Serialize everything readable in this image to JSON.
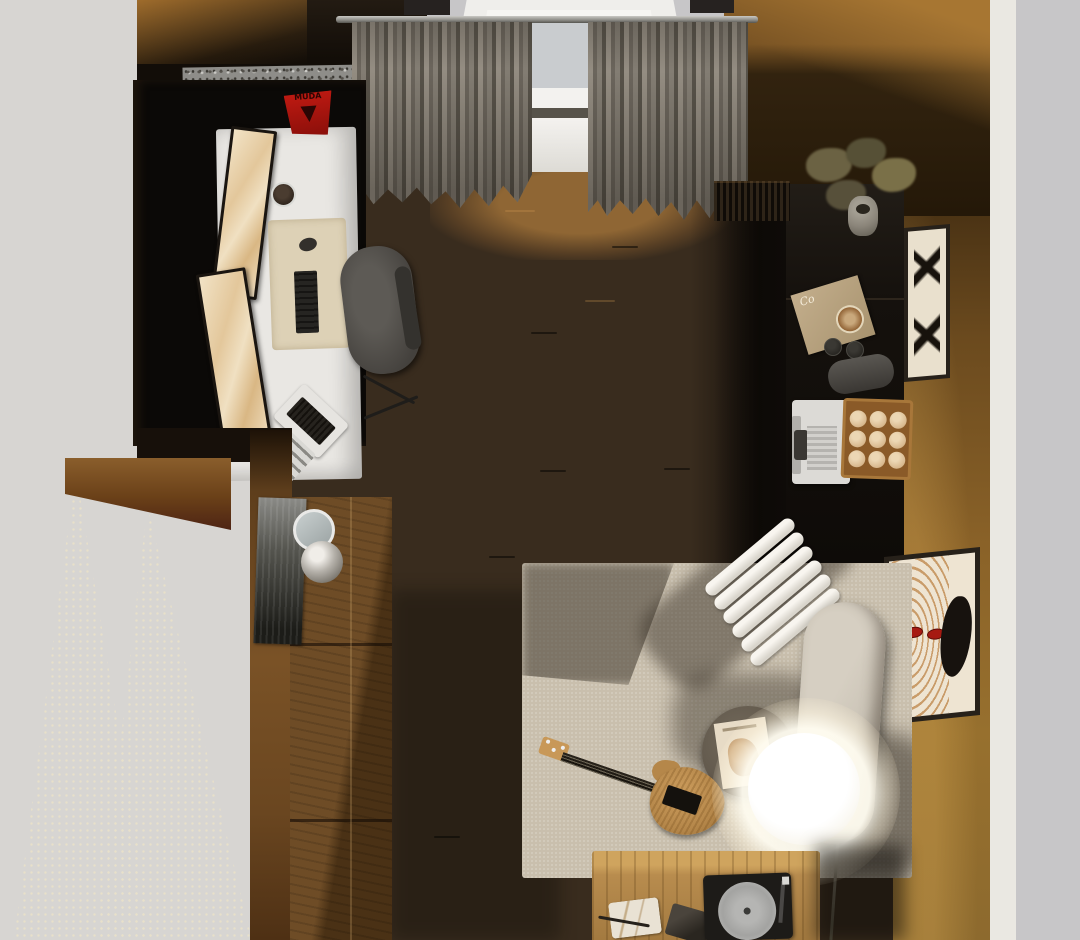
{
  "scene": {
    "type": "3d-room-render",
    "view": "top-down",
    "description": "Top-down render of a cozy home studio: white desk with dual monitors, window with gray curtains, walnut wardrobe, black coffee sideboard with espresso machine and cup tray, beige rug with electric guitar, white ribbed lounge chair, round side table, beige armchair, glowing globe floor lamp and oak media table with turntable"
  },
  "texts": {
    "desk_sign": "MUDA",
    "magazine_initial": "Co"
  },
  "counts": {
    "espresso_cups": 9,
    "lounge_chair_ribs": 6,
    "curtain_panels": 2,
    "monitors": 2,
    "wall_frames": 2
  },
  "palette": {
    "ext-gray": "#c7c6c8",
    "ext-gray-left": "#d7d5d2",
    "ext-dots": "#e8e0ca",
    "wall-white": "#eae8e2",
    "wall-amber": "#8a6228",
    "wall-amber-dark": "#3a270f",
    "wall-left": "#7a5226",
    "floor": "#392c1e",
    "floor-light": "#8a5e2c",
    "curtain": "#8a847a",
    "curtain-dark": "#5c574f",
    "rod": "#a8a7a3",
    "glass": "#c9cccf",
    "sill": "#f3f2ef",
    "desk": "#e9e7e3",
    "desk-mat": "#ddd1b6",
    "monitor-screen": "#ecdabb",
    "black-rug": "#0b0907",
    "chair": "#514e4a",
    "terrazzo": "#8e8d89",
    "sign-red": "#b01810",
    "cabinet-wood": "#5e3f1e",
    "sideboard-black": "#17130f",
    "rug": "#c9bfad",
    "rug-shadow": "rgba(62,54,44,0.55)",
    "tube-white": "#f3f0e9",
    "side-table": "#5f564a",
    "armchair": "#ccc5b8",
    "lamp-core": "#fffef6",
    "table-oak": "#b88c4e",
    "guitar-body": "#b5874a",
    "guitar-neck": "#211c15",
    "cup": "#d8b88e",
    "tray-wood": "#8a5a28",
    "machine-white": "#dcdad6",
    "frame-dark": "#27211a",
    "frame-mat": "#e9e0cd",
    "art-orange": "#c08a50",
    "art-red": "#a61a12",
    "poster-gray": "#66665f",
    "plant-olive": "#6b6243",
    "vase-gray": "#8b857a",
    "mirror-rim": "#e9e9e7",
    "sphere-silver": "#b5b1aa",
    "turntable": "#1d1b18",
    "platter": "#a3a3a1",
    "magazine-cover": "#b9a583",
    "laptop-white": "#e6e4e0"
  },
  "objects": {
    "window": "daylit window",
    "curtains": "gray curtain panels",
    "curtain_rod": "metal curtain rod",
    "terrazzo_ledge": "terrazzo ledge",
    "desk": "white desk",
    "monitors": "dual monitors with marble wallpaper",
    "keyboard": "black keyboard",
    "mouse": "mouse",
    "laptop": "open laptop",
    "desk_mat": "beige desk mat",
    "red_sign": "red desk sign",
    "office_chair": "dark office chair",
    "black_mat": "black floor mat",
    "wardrobe": "walnut wardrobe",
    "poster": "dark abstract poster",
    "mirror": "round mirror",
    "decor_sphere": "silver sphere",
    "doorway": "open doorway to hallway",
    "sideboard": "black coffee sideboard",
    "plant": "dried bouquet in gray vase",
    "coffee_magazine": "coffee magazine",
    "speaker": "gray speaker",
    "coffee_machine": "espresso machine",
    "cup_tray": "wood tray with espresso cups",
    "record_slats": "vinyl record row",
    "frame_botanical": "black botanical print",
    "frame_face": "contour face artwork",
    "rug": "beige area rug",
    "ribbed_chair": "white ribbed lounge chair",
    "side_table": "round side table",
    "table_magazine": "magazine on side table",
    "armchair": "beige armchair",
    "floor_lamp": "glowing globe floor lamp",
    "guitar": "electric guitar",
    "media_table": "oak media table",
    "turntable": "turntable",
    "marble_tray": "marble tray",
    "wedge_speaker": "speaker wedge"
  }
}
